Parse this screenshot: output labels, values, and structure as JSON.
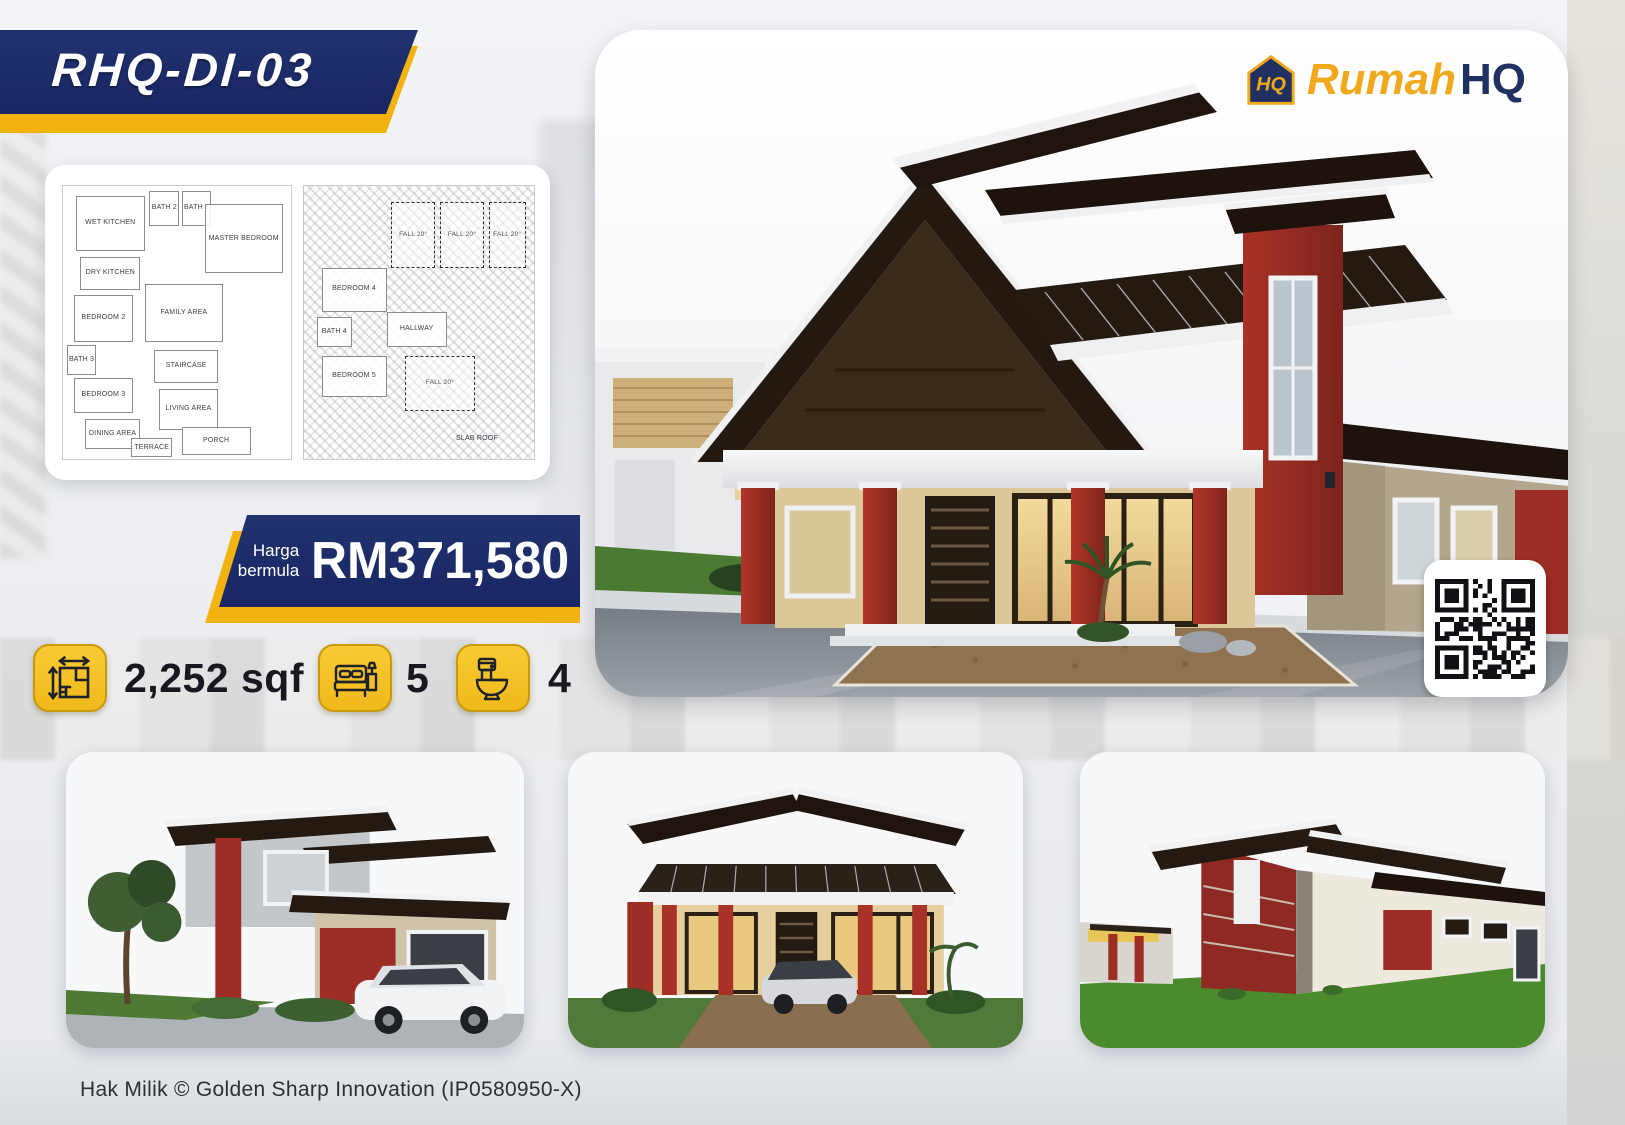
{
  "poster": {
    "model_code": "RHQ-DI-03",
    "brand": {
      "name_yellow": "Rumah",
      "name_navy": "HQ",
      "monogram": "HQ"
    },
    "price": {
      "label_line1": "Harga",
      "label_line2": "bermula",
      "value": "RM371,580"
    },
    "specs": [
      {
        "icon": "floor-area-icon",
        "value": "2,252 sqf"
      },
      {
        "icon": "bed-icon",
        "value": "5"
      },
      {
        "icon": "toilet-icon",
        "value": "4"
      }
    ],
    "floor_plans": {
      "ground_floor": {
        "rooms": [
          "WET KITCHEN",
          "BATH 2",
          "BATH 1",
          "MASTER BEDROOM",
          "DRY KITCHEN",
          "BEDROOM 2",
          "FAMILY AREA",
          "BATH 3",
          "STAIRCASE",
          "BEDROOM 3",
          "LIVING AREA",
          "DINING AREA",
          "TERRACE",
          "PORCH"
        ]
      },
      "first_floor": {
        "rooms": [
          "FALL 20°",
          "FALL 20°",
          "FALL 20°",
          "BEDROOM 4",
          "BATH 4",
          "HALLWAY",
          "BEDROOM 5",
          "FALL 20°",
          "SLAB ROOF"
        ]
      }
    },
    "qr": {
      "modules": 21,
      "seed": 9
    },
    "footer": "Hak Milik © Golden Sharp Innovation (IP0580950-X)",
    "colors": {
      "navy": "#1c2d6d",
      "yellow": "#f2b30f",
      "tile_yellow": "#f6c62e",
      "red_accent": "#9e2d25"
    }
  }
}
